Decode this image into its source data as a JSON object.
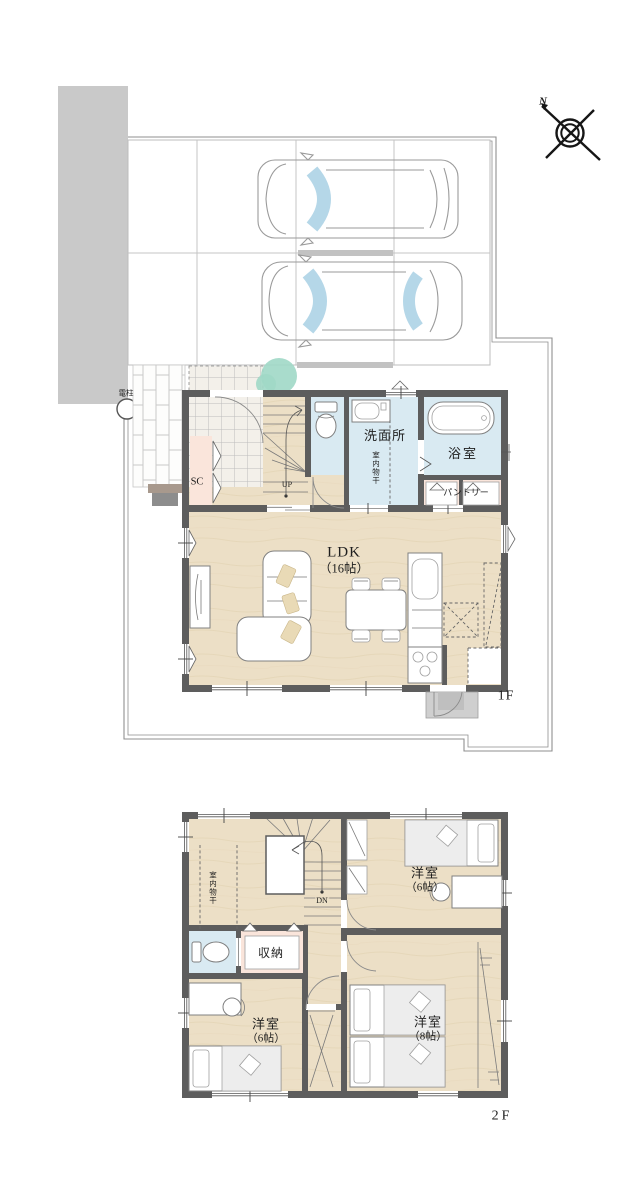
{
  "site": {
    "utility_pole_label": "電柱",
    "compass_north_label": "N",
    "floor1_tag": "1F",
    "floor2_tag": "2F"
  },
  "floor1": {
    "shoe_closet_label": "SC",
    "stairs_up_label": "UP",
    "washroom_label": "洗面所",
    "indoor_drying_label": "室内物干",
    "bathroom_label": "浴室",
    "pantry_label": "パントリー",
    "ldk_name": "LDK",
    "ldk_size": "（16帖）"
  },
  "floor2": {
    "indoor_drying_label": "室内物干",
    "stairs_down_label": "DN",
    "storage_label": "収納",
    "room_ne_name": "洋室",
    "room_ne_size": "（6帖）",
    "room_sw_name": "洋室",
    "room_sw_size": "（6帖）",
    "room_se_name": "洋室",
    "room_se_size": "（8帖）"
  },
  "colors": {
    "wall": "#5d5d5d",
    "wood_floor": "#ecdfc6",
    "wet_floor": "#d9eaf2",
    "closet_floor": "#fae5db",
    "glass": "#b5d7e8",
    "shrub": "#a0d8c7"
  }
}
